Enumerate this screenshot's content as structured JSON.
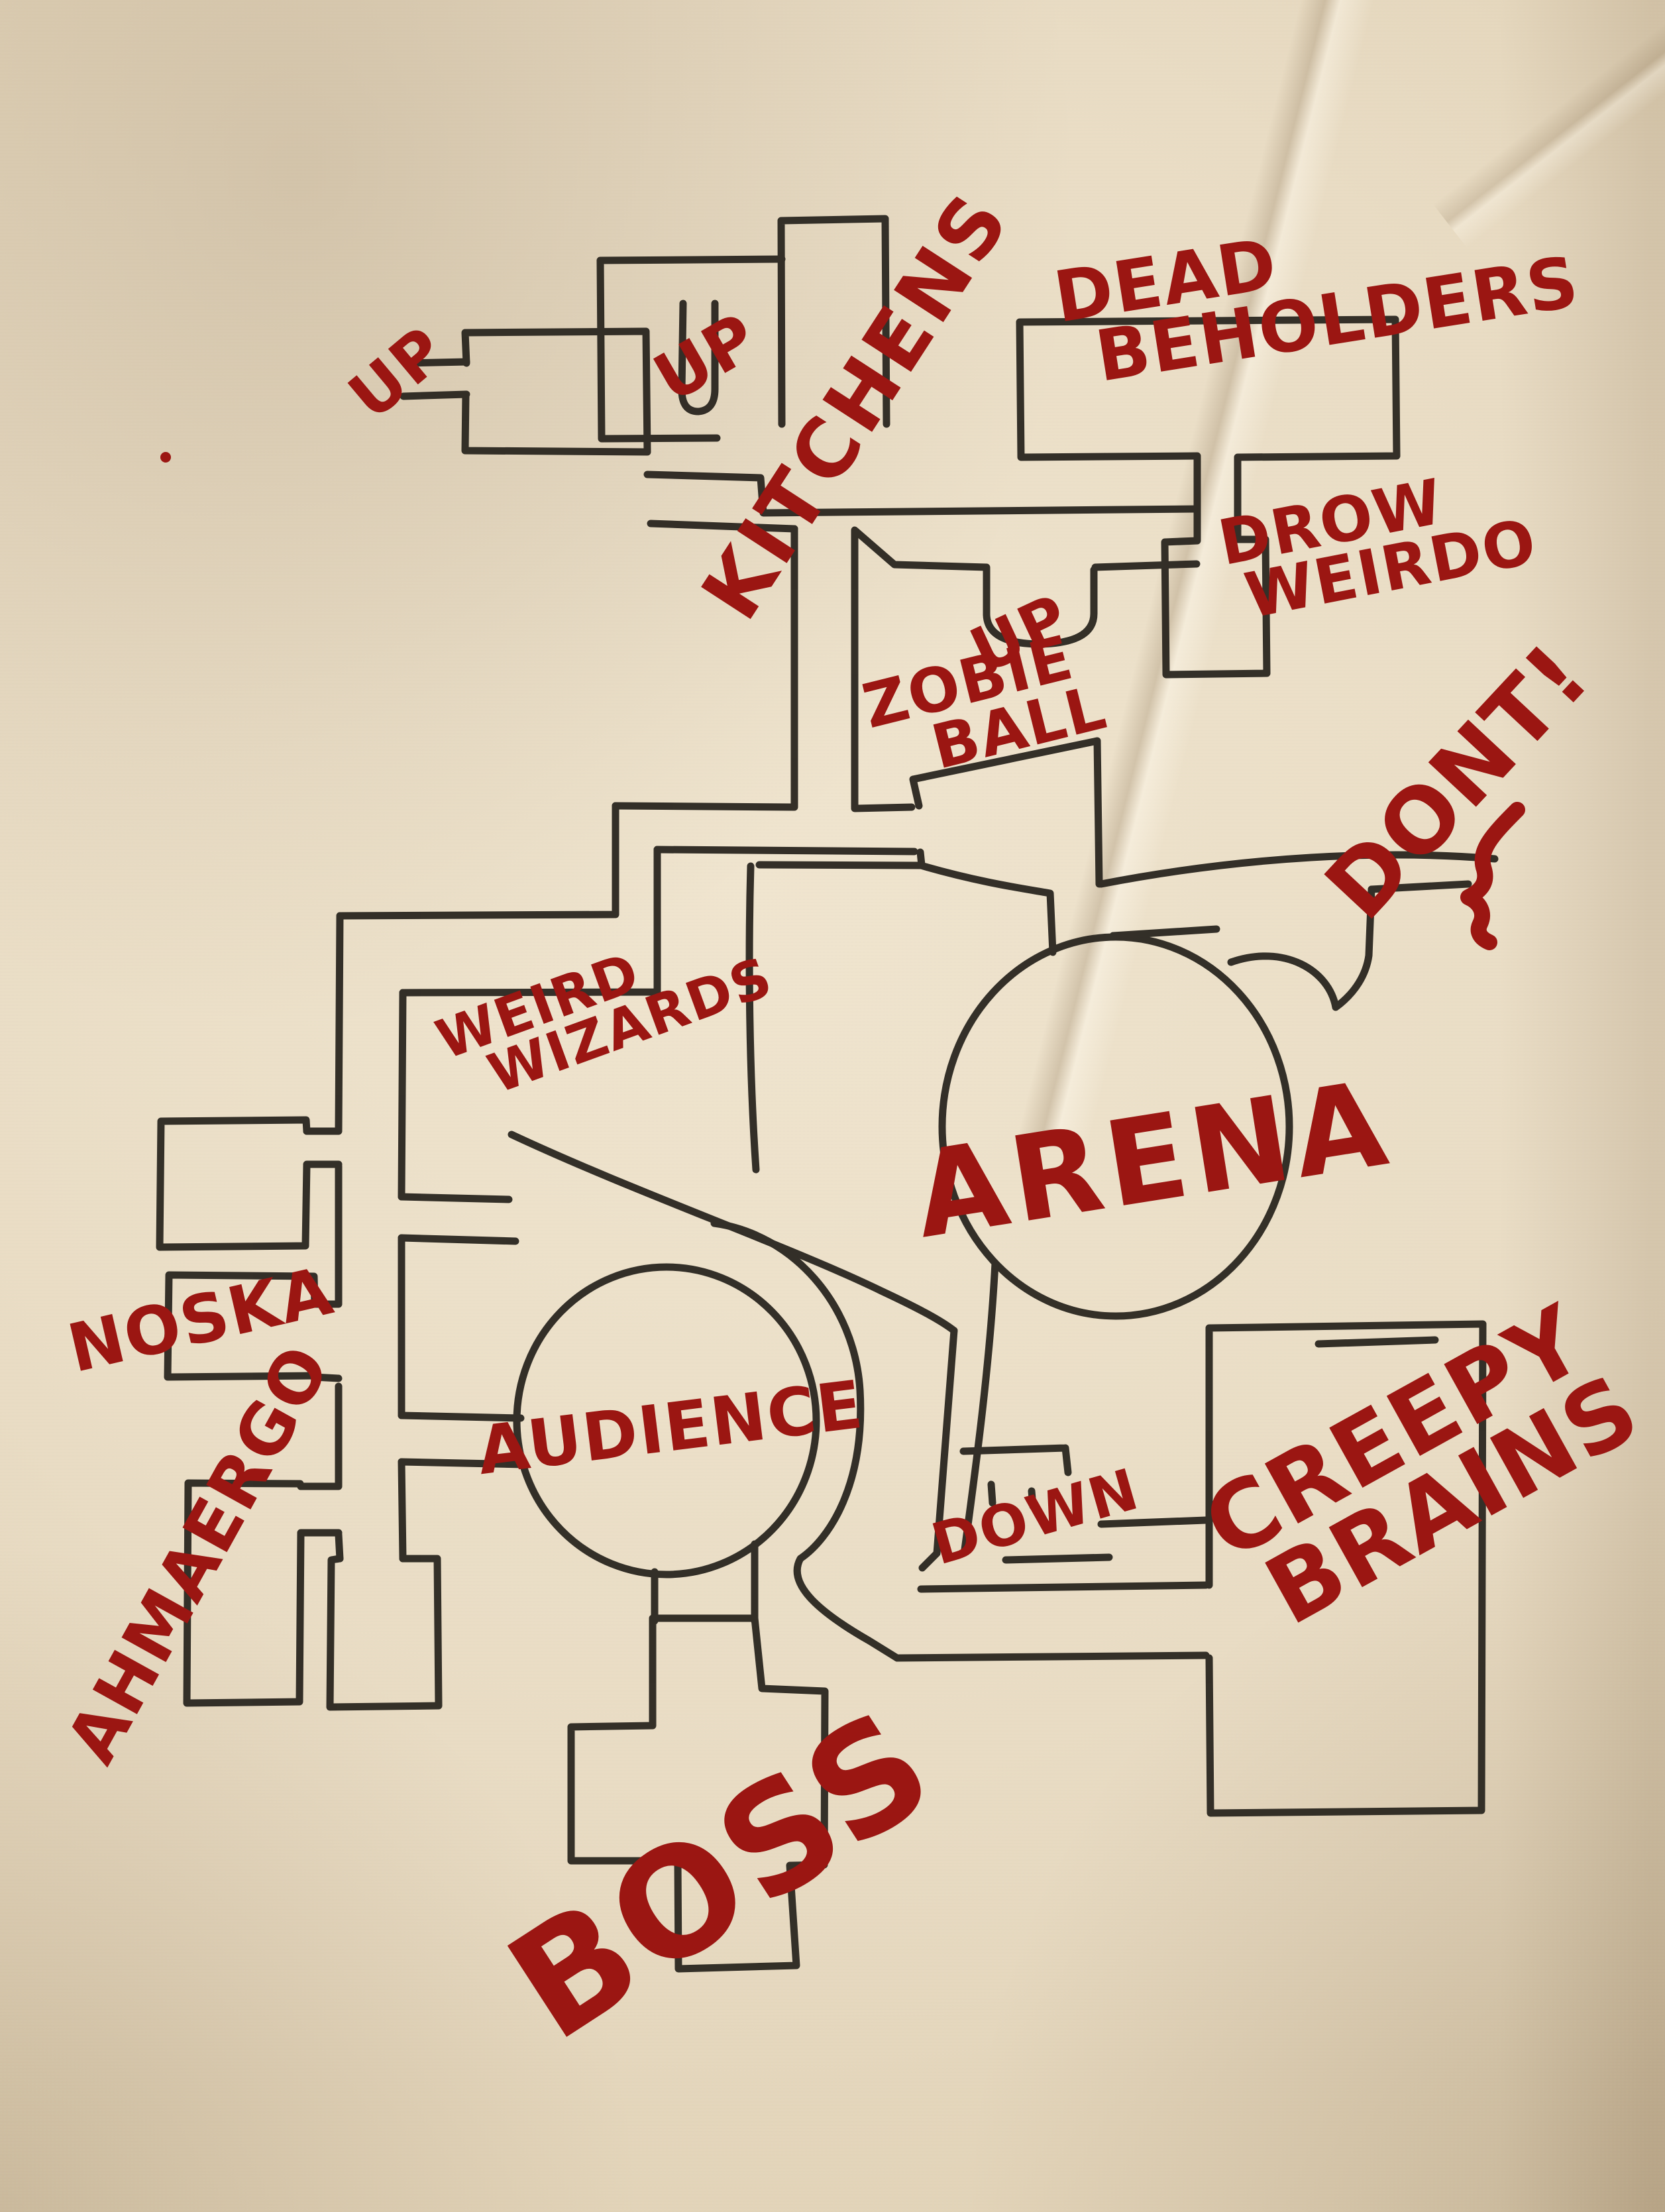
{
  "document_type": "hand-drawn dungeon map",
  "colors": {
    "paper": "#e9dcc4",
    "ink": "#26221c",
    "marker_red": "#9b1612"
  },
  "labels": {
    "up_west": {
      "text": "UP"
    },
    "up_center": {
      "text": "UP"
    },
    "kitchens": {
      "text": "KITCHENS"
    },
    "dead_beholders": {
      "line1": "DEAD",
      "line2": "BEHOLDERS"
    },
    "drow_weirdo": {
      "line1": "DROW",
      "line2": "WEIRDO"
    },
    "up_stairs": {
      "text": "UP"
    },
    "zobie_ball": {
      "line1": "ZOBIE",
      "line2": "BALL"
    },
    "dont": {
      "text": "DONT!"
    },
    "weird_wizards": {
      "line1": "WEIRD",
      "line2": "WIZARDS"
    },
    "arena": {
      "text": "ARENA"
    },
    "noska": {
      "text": "NOSKA"
    },
    "ahmaergo": {
      "text": "AHMAERGO"
    },
    "audience": {
      "text": "AUDIENCE"
    },
    "down": {
      "text": "DOWN"
    },
    "creepy_brains": {
      "line1": "CREEPY",
      "line2": "BRAINS"
    },
    "boss": {
      "text": "BOSS"
    }
  }
}
